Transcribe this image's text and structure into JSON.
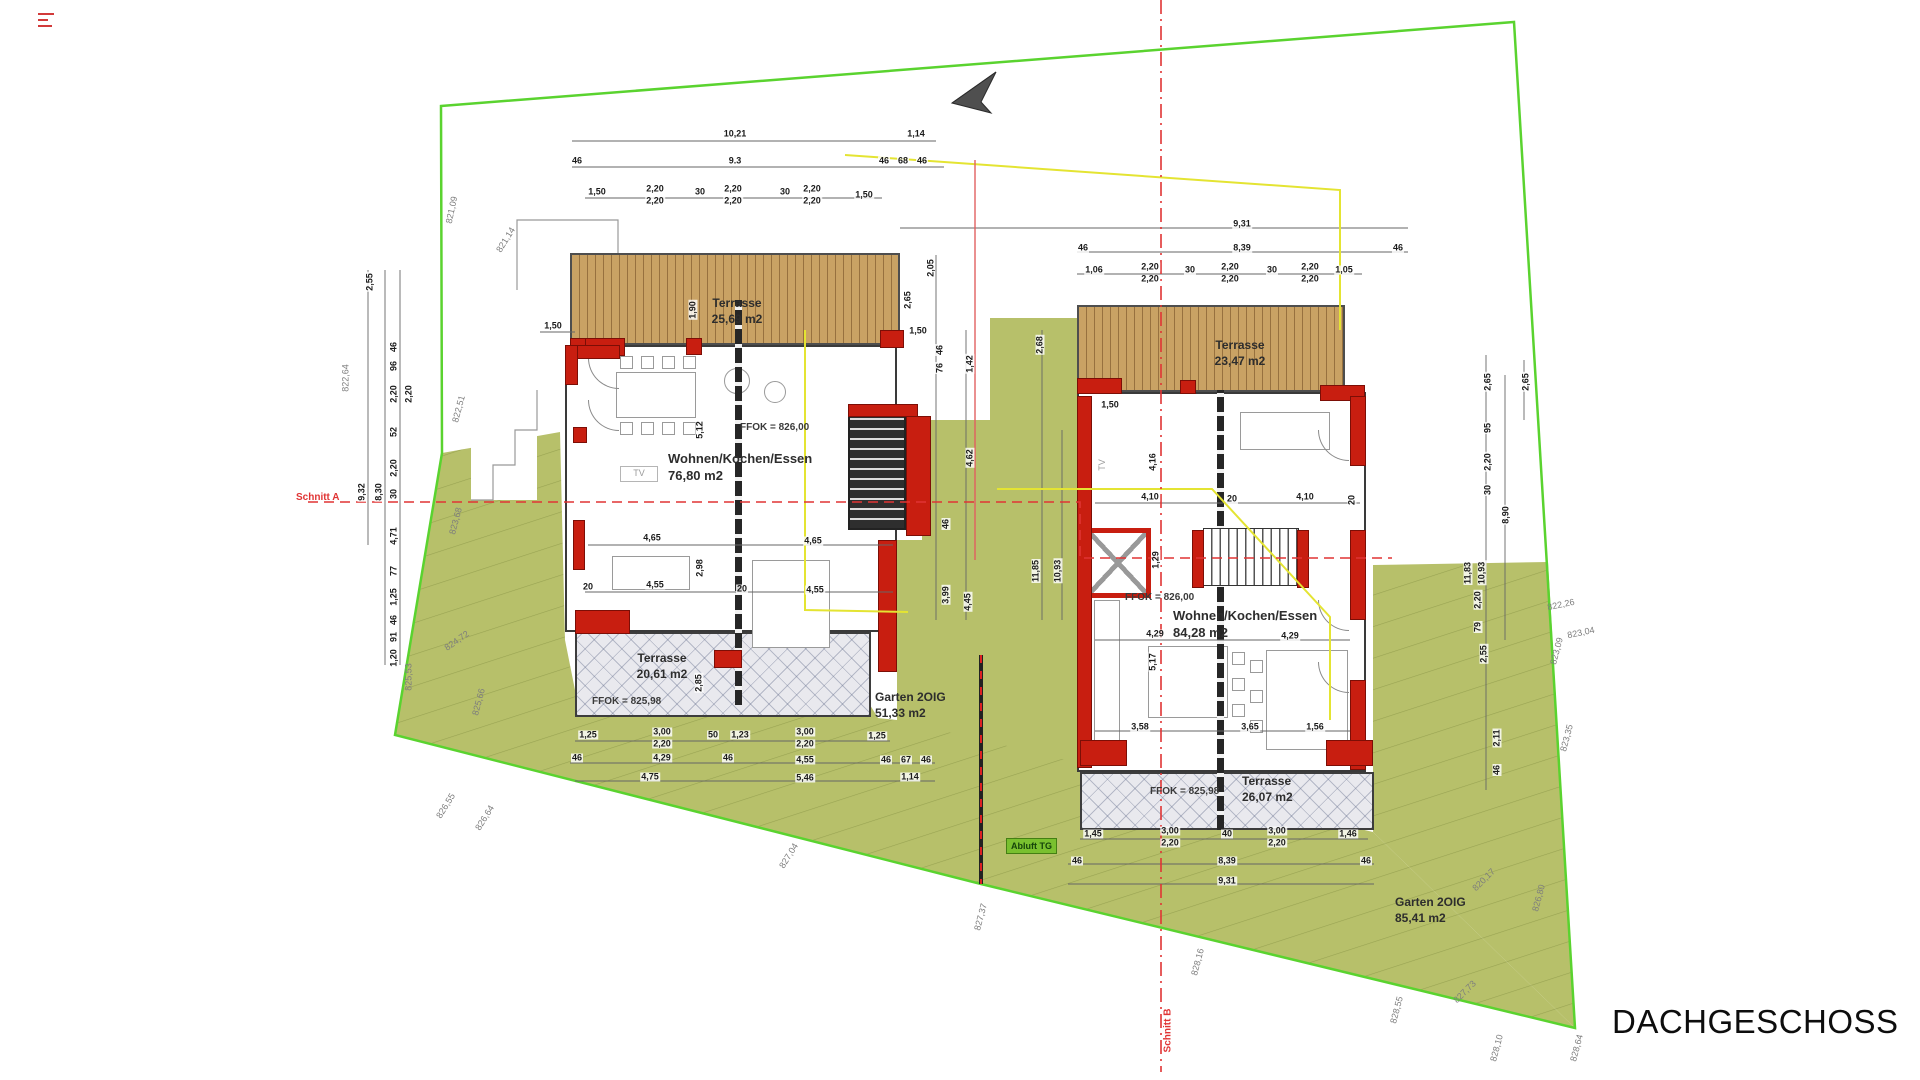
{
  "title_block": {
    "label": "DACHGESCHOSS"
  },
  "site": {
    "schnitt_a": "Schnitt A",
    "schnitt_b": "Schnitt B",
    "abluft_tg": "Abluft TG"
  },
  "left_house": {
    "terrace_top_name": "Terrasse",
    "terrace_top_area": "25,69 m2",
    "living_name": "Wohnen/Kochen/Essen",
    "living_area": "76,80 m2",
    "ffok_main": "FFOK = 826,00",
    "terrace_bottom_name": "Terrasse",
    "terrace_bottom_area": "20,61 m2",
    "ffok_terrace": "FFOK = 825,98",
    "garden_name": "Garten 2OIG",
    "garden_area": "51,33 m2",
    "tv_label": "TV"
  },
  "right_house": {
    "terrace_top_name": "Terrasse",
    "terrace_top_area": "23,47 m2",
    "living_name": "Wohnen/Kochen/Essen",
    "living_area": "84,28 m2",
    "ffok_main": "FFOK = 826,00",
    "terrace_bottom_name": "Terrasse",
    "terrace_bottom_area": "26,07 m2",
    "ffok_terrace": "FFOK = 825,98",
    "garden_name": "Garten 2OIG",
    "garden_area": "85,41 m2",
    "tv_label": "TV"
  },
  "colors": {
    "boundary": "#5ad32f",
    "garden": "#b7c06a",
    "garden_line": "#98a352",
    "wallred": "#c81e10",
    "section": "#e03434",
    "yellow": "#e4e432",
    "wood": "#c9a264",
    "wood_dark": "#97713f"
  },
  "dim_labels": [
    {
      "t": "10,21",
      "x": 735,
      "y": 134
    },
    {
      "t": "1,14",
      "x": 916,
      "y": 134
    },
    {
      "t": "46",
      "x": 577,
      "y": 161
    },
    {
      "t": "9.3",
      "x": 735,
      "y": 161
    },
    {
      "t": "46",
      "x": 884,
      "y": 161
    },
    {
      "t": "68",
      "x": 903,
      "y": 161
    },
    {
      "t": "46",
      "x": 922,
      "y": 161
    },
    {
      "t": "1,50",
      "x": 597,
      "y": 192
    },
    {
      "t": "2,20",
      "x": 655,
      "y": 189
    },
    {
      "t": "2,20",
      "x": 655,
      "y": 201
    },
    {
      "t": "30",
      "x": 700,
      "y": 192
    },
    {
      "t": "2,20",
      "x": 733,
      "y": 189
    },
    {
      "t": "2,20",
      "x": 733,
      "y": 201
    },
    {
      "t": "30",
      "x": 785,
      "y": 192
    },
    {
      "t": "2,20",
      "x": 812,
      "y": 189
    },
    {
      "t": "2,20",
      "x": 812,
      "y": 201
    },
    {
      "t": "1,50",
      "x": 864,
      "y": 195
    },
    {
      "t": "1,50",
      "x": 553,
      "y": 326
    },
    {
      "t": "2,55",
      "x": 370,
      "y": 282,
      "r": -90
    },
    {
      "t": "46",
      "x": 394,
      "y": 347,
      "r": -90
    },
    {
      "t": "96",
      "x": 394,
      "y": 366,
      "r": -90
    },
    {
      "t": "2,20",
      "x": 394,
      "y": 394,
      "r": -90
    },
    {
      "t": "2,20",
      "x": 409,
      "y": 394,
      "r": -90
    },
    {
      "t": "52",
      "x": 394,
      "y": 432,
      "r": -90
    },
    {
      "t": "2,20",
      "x": 394,
      "y": 468,
      "r": -90
    },
    {
      "t": "30",
      "x": 394,
      "y": 494,
      "r": -90
    },
    {
      "t": "9,32",
      "x": 362,
      "y": 492,
      "r": -90
    },
    {
      "t": "8,30",
      "x": 379,
      "y": 492,
      "r": -90
    },
    {
      "t": "4,71",
      "x": 394,
      "y": 536,
      "r": -90
    },
    {
      "t": "77",
      "x": 394,
      "y": 571,
      "r": -90
    },
    {
      "t": "1,25",
      "x": 394,
      "y": 597,
      "r": -90
    },
    {
      "t": "46",
      "x": 394,
      "y": 620,
      "r": -90
    },
    {
      "t": "91",
      "x": 394,
      "y": 637,
      "r": -90
    },
    {
      "t": "1,20",
      "x": 394,
      "y": 658,
      "r": -90
    },
    {
      "t": "5,12",
      "x": 700,
      "y": 430,
      "r": -90
    },
    {
      "t": "1,90",
      "x": 693,
      "y": 310,
      "r": -90
    },
    {
      "t": "20",
      "x": 588,
      "y": 587
    },
    {
      "t": "20",
      "x": 742,
      "y": 589
    },
    {
      "t": "4,65",
      "x": 652,
      "y": 538
    },
    {
      "t": "4,65",
      "x": 813,
      "y": 541
    },
    {
      "t": "4,55",
      "x": 655,
      "y": 585
    },
    {
      "t": "4,55",
      "x": 815,
      "y": 590
    },
    {
      "t": "2,98",
      "x": 700,
      "y": 568,
      "r": -90
    },
    {
      "t": "2,85",
      "x": 699,
      "y": 683,
      "r": -90
    },
    {
      "t": "1,25",
      "x": 588,
      "y": 735
    },
    {
      "t": "3,00",
      "x": 662,
      "y": 732
    },
    {
      "t": "2,20",
      "x": 662,
      "y": 744
    },
    {
      "t": "50",
      "x": 713,
      "y": 735
    },
    {
      "t": "1,23",
      "x": 740,
      "y": 735
    },
    {
      "t": "3,00",
      "x": 805,
      "y": 732
    },
    {
      "t": "2,20",
      "x": 805,
      "y": 744
    },
    {
      "t": "1,25",
      "x": 877,
      "y": 736
    },
    {
      "t": "46",
      "x": 577,
      "y": 758
    },
    {
      "t": "4,29",
      "x": 662,
      "y": 758
    },
    {
      "t": "46",
      "x": 728,
      "y": 758
    },
    {
      "t": "4,55",
      "x": 805,
      "y": 760
    },
    {
      "t": "46",
      "x": 886,
      "y": 760
    },
    {
      "t": "67",
      "x": 906,
      "y": 760
    },
    {
      "t": "46",
      "x": 926,
      "y": 760
    },
    {
      "t": "4,75",
      "x": 650,
      "y": 777
    },
    {
      "t": "5,46",
      "x": 805,
      "y": 778
    },
    {
      "t": "1,14",
      "x": 910,
      "y": 777
    },
    {
      "t": "2,05",
      "x": 931,
      "y": 268,
      "r": -90
    },
    {
      "t": "2,65",
      "x": 908,
      "y": 300,
      "r": -90
    },
    {
      "t": "1,50",
      "x": 918,
      "y": 331
    },
    {
      "t": "46",
      "x": 940,
      "y": 350,
      "r": -90
    },
    {
      "t": "76",
      "x": 940,
      "y": 368,
      "r": -90
    },
    {
      "t": "1,42",
      "x": 970,
      "y": 364,
      "r": -90
    },
    {
      "t": "2,68",
      "x": 1040,
      "y": 345,
      "r": -90
    },
    {
      "t": "4,62",
      "x": 970,
      "y": 458,
      "r": -90
    },
    {
      "t": "46",
      "x": 946,
      "y": 524,
      "r": -90
    },
    {
      "t": "3,99",
      "x": 946,
      "y": 595,
      "r": -90
    },
    {
      "t": "4,45",
      "x": 968,
      "y": 602,
      "r": -90
    },
    {
      "t": "11,85",
      "x": 1036,
      "y": 571,
      "r": -90
    },
    {
      "t": "10,93",
      "x": 1058,
      "y": 571,
      "r": -90
    },
    {
      "t": "1,50",
      "x": 1110,
      "y": 405
    },
    {
      "t": "9,31",
      "x": 1242,
      "y": 224
    },
    {
      "t": "46",
      "x": 1083,
      "y": 248
    },
    {
      "t": "8,39",
      "x": 1242,
      "y": 248
    },
    {
      "t": "46",
      "x": 1398,
      "y": 248
    },
    {
      "t": "1,06",
      "x": 1094,
      "y": 270
    },
    {
      "t": "2,20",
      "x": 1150,
      "y": 267
    },
    {
      "t": "2,20",
      "x": 1150,
      "y": 279
    },
    {
      "t": "30",
      "x": 1190,
      "y": 270
    },
    {
      "t": "2,20",
      "x": 1230,
      "y": 267
    },
    {
      "t": "2,20",
      "x": 1230,
      "y": 279
    },
    {
      "t": "30",
      "x": 1272,
      "y": 270
    },
    {
      "t": "2,20",
      "x": 1310,
      "y": 267
    },
    {
      "t": "2,20",
      "x": 1310,
      "y": 279
    },
    {
      "t": "1,05",
      "x": 1344,
      "y": 270
    },
    {
      "t": "4,16",
      "x": 1153,
      "y": 462,
      "r": -90
    },
    {
      "t": "4,10",
      "x": 1150,
      "y": 497
    },
    {
      "t": "20",
      "x": 1232,
      "y": 499
    },
    {
      "t": "4,10",
      "x": 1305,
      "y": 497
    },
    {
      "t": "20",
      "x": 1352,
      "y": 500,
      "r": -90
    },
    {
      "t": "1,29",
      "x": 1156,
      "y": 560,
      "r": -90
    },
    {
      "t": "4,29",
      "x": 1155,
      "y": 634
    },
    {
      "t": "4,29",
      "x": 1290,
      "y": 636
    },
    {
      "t": "5,17",
      "x": 1153,
      "y": 662,
      "r": -90
    },
    {
      "t": "3,58",
      "x": 1140,
      "y": 727
    },
    {
      "t": "3,65",
      "x": 1250,
      "y": 727
    },
    {
      "t": "1,56",
      "x": 1315,
      "y": 727
    },
    {
      "t": "2,65",
      "x": 1488,
      "y": 382,
      "r": -90
    },
    {
      "t": "2,65",
      "x": 1526,
      "y": 382,
      "r": -90
    },
    {
      "t": "95",
      "x": 1488,
      "y": 428,
      "r": -90
    },
    {
      "t": "2,20",
      "x": 1488,
      "y": 462,
      "r": -90
    },
    {
      "t": "30",
      "x": 1488,
      "y": 490,
      "r": -90
    },
    {
      "t": "8,90",
      "x": 1506,
      "y": 515,
      "r": -90
    },
    {
      "t": "11,83",
      "x": 1468,
      "y": 573,
      "r": -90
    },
    {
      "t": "10,93",
      "x": 1482,
      "y": 573,
      "r": -90
    },
    {
      "t": "2,20",
      "x": 1478,
      "y": 600,
      "r": -90
    },
    {
      "t": "79",
      "x": 1478,
      "y": 627,
      "r": -90
    },
    {
      "t": "2,55",
      "x": 1484,
      "y": 654,
      "r": -90
    },
    {
      "t": "2,11",
      "x": 1497,
      "y": 738,
      "r": -90
    },
    {
      "t": "46",
      "x": 1497,
      "y": 770,
      "r": -90
    },
    {
      "t": "1,45",
      "x": 1093,
      "y": 834
    },
    {
      "t": "3,00",
      "x": 1170,
      "y": 831
    },
    {
      "t": "2,20",
      "x": 1170,
      "y": 843
    },
    {
      "t": "40",
      "x": 1227,
      "y": 834
    },
    {
      "t": "3,00",
      "x": 1277,
      "y": 831
    },
    {
      "t": "2,20",
      "x": 1277,
      "y": 843
    },
    {
      "t": "1,46",
      "x": 1348,
      "y": 834
    },
    {
      "t": "46",
      "x": 1077,
      "y": 861
    },
    {
      "t": "8,39",
      "x": 1227,
      "y": 861
    },
    {
      "t": "46",
      "x": 1366,
      "y": 861
    },
    {
      "t": "9,31",
      "x": 1227,
      "y": 881
    }
  ],
  "elevation_labels": [
    {
      "t": "821,09",
      "x": 452,
      "y": 210,
      "r": -78
    },
    {
      "t": "821,14",
      "x": 506,
      "y": 240,
      "r": -58
    },
    {
      "t": "822,64",
      "x": 346,
      "y": 378,
      "r": -90
    },
    {
      "t": "822,51",
      "x": 459,
      "y": 409,
      "r": -75
    },
    {
      "t": "823,68",
      "x": 456,
      "y": 521,
      "r": -75
    },
    {
      "t": "824,72",
      "x": 457,
      "y": 641,
      "r": -35
    },
    {
      "t": "825,66",
      "x": 479,
      "y": 702,
      "r": -75
    },
    {
      "t": "825,53",
      "x": 409,
      "y": 677,
      "r": -90
    },
    {
      "t": "826,55",
      "x": 446,
      "y": 806,
      "r": -58
    },
    {
      "t": "826,64",
      "x": 485,
      "y": 818,
      "r": -58
    },
    {
      "t": "827,04",
      "x": 789,
      "y": 856,
      "r": -58
    },
    {
      "t": "827,37",
      "x": 981,
      "y": 917,
      "r": -75
    },
    {
      "t": "828,16",
      "x": 1198,
      "y": 962,
      "r": -75
    },
    {
      "t": "828,55",
      "x": 1397,
      "y": 1010,
      "r": -75
    },
    {
      "t": "828,10",
      "x": 1497,
      "y": 1048,
      "r": -75
    },
    {
      "t": "828,64",
      "x": 1577,
      "y": 1048,
      "r": -75
    },
    {
      "t": "827,73",
      "x": 1465,
      "y": 992,
      "r": -45
    },
    {
      "t": "820,17",
      "x": 1484,
      "y": 880,
      "r": -45
    },
    {
      "t": "826,80",
      "x": 1539,
      "y": 898,
      "r": -75
    },
    {
      "t": "822,26",
      "x": 1561,
      "y": 605,
      "r": -12
    },
    {
      "t": "823,04",
      "x": 1581,
      "y": 633,
      "r": -12
    },
    {
      "t": "823,09",
      "x": 1557,
      "y": 651,
      "r": -75
    },
    {
      "t": "823,35",
      "x": 1567,
      "y": 738,
      "r": -75
    }
  ]
}
